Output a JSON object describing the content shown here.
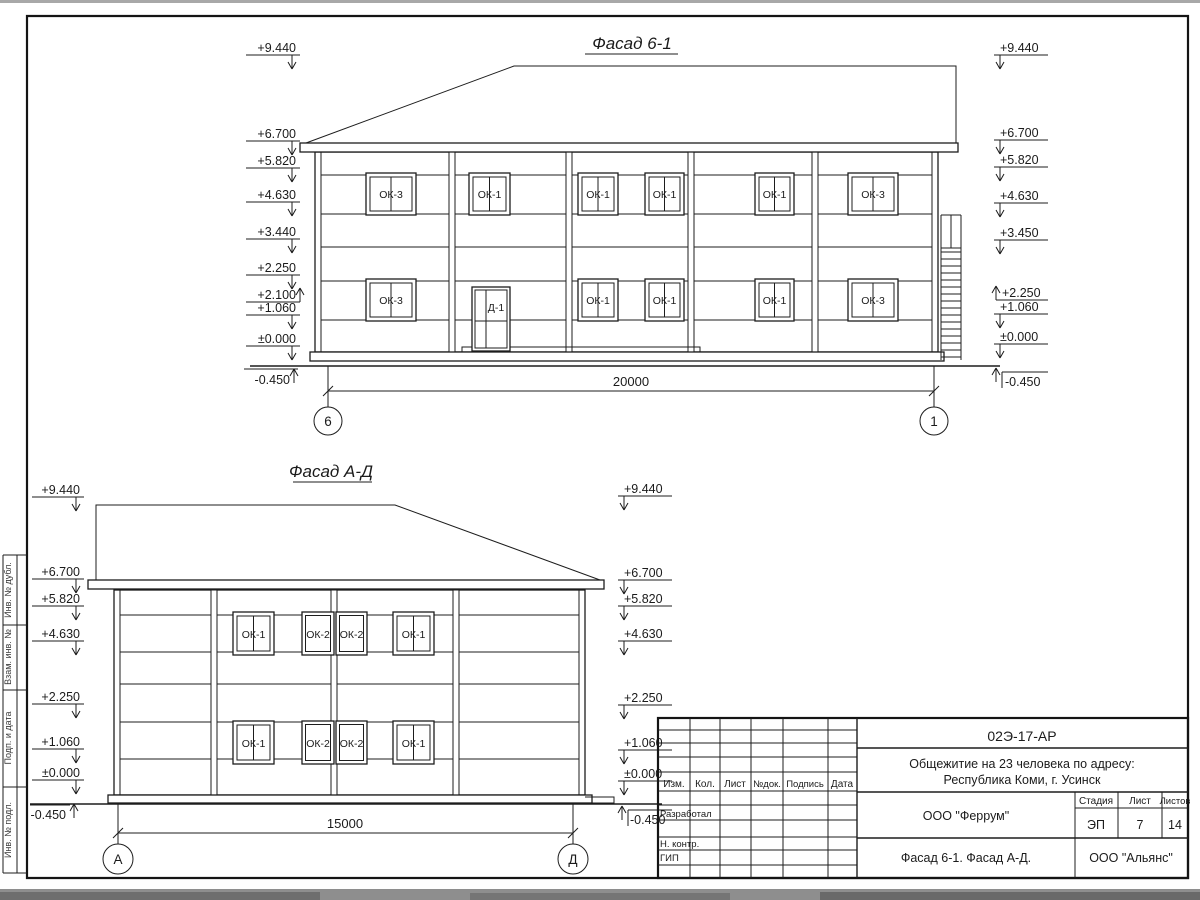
{
  "sheet": {
    "paper_color": "#ffffff",
    "line_color": "#1d1d1d"
  },
  "f1": {
    "title": "Фасад 6-1",
    "marks_left": [
      "+9.440",
      "+6.700",
      "+5.820",
      "+4.630",
      "+3.440",
      "+2.250",
      "+2.100",
      "+1.060",
      "±0.000",
      "-0.450"
    ],
    "marks_right": [
      "+9.440",
      "+6.700",
      "+5.820",
      "+4.630",
      "+3.450",
      "+2.250",
      "+1.060",
      "±0.000",
      "-0.450"
    ],
    "windows_upper": [
      "ОК-3",
      "ОК-1",
      "ОК-1",
      "ОК-1",
      "ОК-1",
      "ОК-3"
    ],
    "windows_lower": [
      "ОК-3",
      "ОК-1",
      "ОК-1",
      "ОК-1",
      "ОК-3"
    ],
    "door_label": "Д-1",
    "dimension": "20000",
    "axis_left": "6",
    "axis_right": "1"
  },
  "f2": {
    "title": "Фасад А-Д",
    "marks_left": [
      "+9.440",
      "+6.700",
      "+5.820",
      "+4.630",
      "+2.250",
      "+1.060",
      "±0.000",
      "-0.450"
    ],
    "marks_right": [
      "+9.440",
      "+6.700",
      "+5.820",
      "+4.630",
      "+2.250",
      "+1.060",
      "±0.000",
      "-0.450"
    ],
    "windows_upper": [
      "ОК-1",
      "ОК-2",
      "ОК-2",
      "ОК-1"
    ],
    "windows_lower": [
      "ОК-1",
      "ОК-2",
      "ОК-2",
      "ОК-1"
    ],
    "dimension": "15000",
    "axis_left": "А",
    "axis_right": "Д"
  },
  "tb": {
    "doc_code": "02Э-17-АР",
    "object_line1": "Общежитие на 23 человека по адресу:",
    "object_line2": "Республика Коми, г. Усинск",
    "org": "ООО \"Феррум\"",
    "stage_label": "Стадия",
    "sheet_label": "Лист",
    "sheets_label": "Листов",
    "stage": "ЭП",
    "sheet": "7",
    "sheets": "14",
    "sheet_title": "Фасад 6-1. Фасад  А-Д.",
    "contractor": "ООО \"Альянс\"",
    "cols": [
      "Изм.",
      "Кол.",
      "Лист",
      "№док.",
      "Подпись",
      "Дата"
    ],
    "rows": [
      "Разработал",
      "Н. контр.",
      "ГИП"
    ]
  },
  "frame": {
    "side": [
      "Инв. № дубл.",
      "Взам. инв. №",
      "Подп. и дата",
      "Инв. № подл."
    ]
  }
}
